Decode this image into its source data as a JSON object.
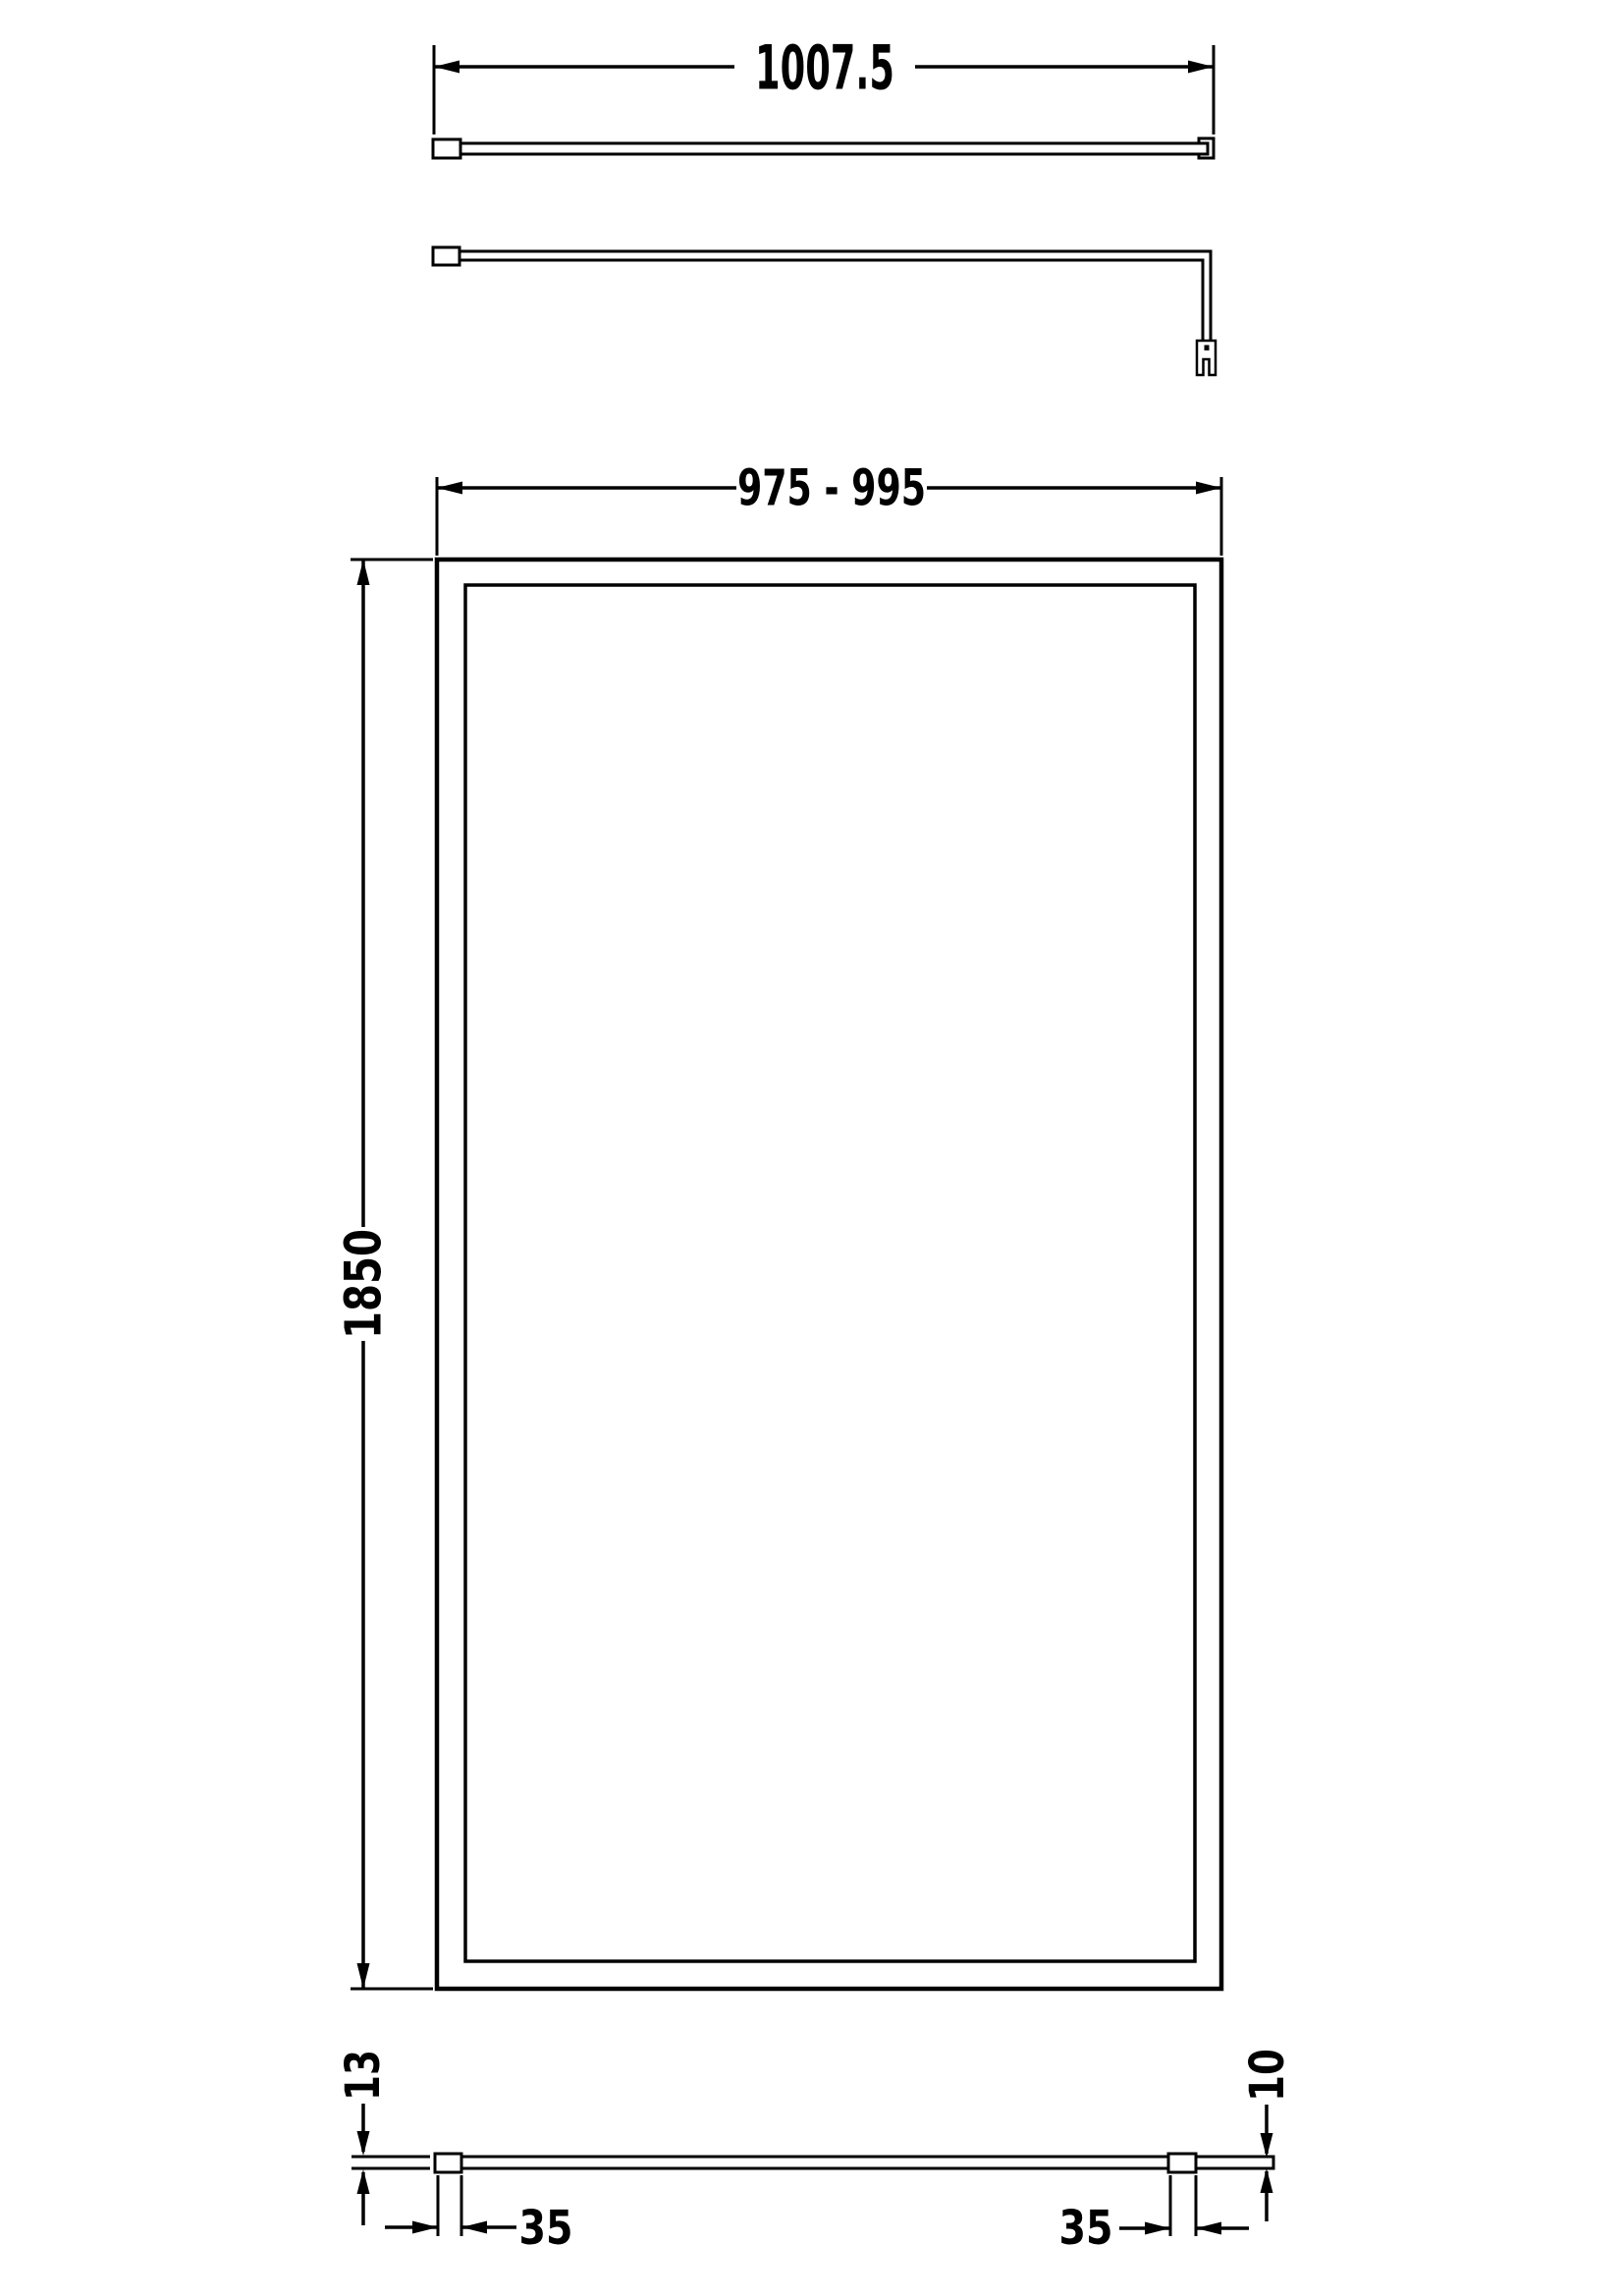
{
  "meta": {
    "background_color": "#ffffff",
    "line_color": "#000000",
    "drawing_type": "technical dimension drawing (wet-room shower screen with support bar)"
  },
  "views": {
    "bar_top": {
      "length": "1007.5"
    },
    "panel_front": {
      "width_range": "975 - 995",
      "height": "1850"
    },
    "panel_plan": {
      "wall_profile_depth": "13",
      "panel_thickness": "10",
      "wall_profile_width": "35",
      "bracket_width": "35"
    }
  }
}
